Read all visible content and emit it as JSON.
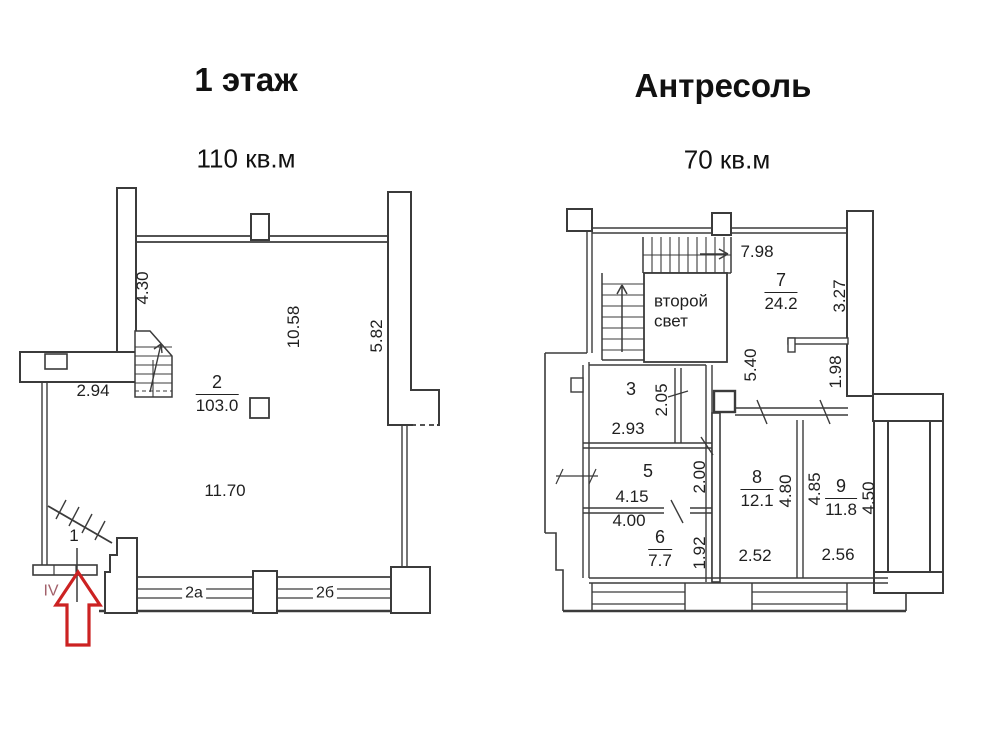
{
  "colors": {
    "line": "#3b3b3b",
    "text": "#1f1f1f",
    "arrow_red": "#cc2222",
    "roman_maroon": "#a2606a"
  },
  "left_plan": {
    "title": "1 этаж",
    "area_label": "110 кв.м",
    "rooms": [
      {
        "name": "room-2-label",
        "num": "2",
        "area": "103.0",
        "x": 217,
        "y": 394
      }
    ],
    "labels": [
      {
        "name": "dim-4-30",
        "text": "4.30",
        "x": 143,
        "y": 288,
        "rot": true,
        "size": 17
      },
      {
        "name": "dim-10-58",
        "text": "10.58",
        "x": 294,
        "y": 327,
        "rot": true,
        "size": 17
      },
      {
        "name": "dim-5-82",
        "text": "5.82",
        "x": 377,
        "y": 336,
        "rot": true,
        "size": 17
      },
      {
        "name": "dim-2-94",
        "text": "2.94",
        "x": 93,
        "y": 391,
        "size": 17
      },
      {
        "name": "dim-11-70",
        "text": "11.70",
        "x": 225,
        "y": 491,
        "size": 17
      },
      {
        "name": "room-1-number",
        "text": "1",
        "x": 74,
        "y": 536,
        "size": 17
      },
      {
        "name": "entrance-roman-numeral",
        "text": "IV",
        "x": 51,
        "y": 591,
        "size": 16,
        "color": "#a2606a"
      },
      {
        "name": "window-2a-label",
        "text": "2a",
        "x": 194,
        "y": 593,
        "size": 16,
        "bg": true
      },
      {
        "name": "window-2b-label",
        "text": "2б",
        "x": 325,
        "y": 593,
        "size": 16,
        "bg": true
      }
    ]
  },
  "right_plan": {
    "title": "Антресоль",
    "area_label": "70 кв.м",
    "second_light_lines": [
      "второй",
      "свет"
    ],
    "rooms": [
      {
        "name": "room-7-label",
        "num": "7",
        "area": "24.2",
        "x": 781,
        "y": 292
      },
      {
        "name": "room-6-label",
        "num": "6",
        "area": "7.7",
        "x": 660,
        "y": 549
      },
      {
        "name": "room-8-label",
        "num": "8",
        "area": "12.1",
        "x": 757,
        "y": 489
      },
      {
        "name": "room-9-label",
        "num": "9",
        "area": "11.8",
        "x": 841,
        "y": 498
      }
    ],
    "labels": [
      {
        "name": "dim-7-98",
        "text": "7.98",
        "x": 757,
        "y": 252,
        "size": 17
      },
      {
        "name": "dim-3-27",
        "text": "3.27",
        "x": 840,
        "y": 296,
        "rot": true,
        "size": 17
      },
      {
        "name": "dim-5-40",
        "text": "5.40",
        "x": 751,
        "y": 365,
        "rot": true,
        "size": 17
      },
      {
        "name": "dim-1-98",
        "text": "1.98",
        "x": 836,
        "y": 372,
        "rot": true,
        "size": 17
      },
      {
        "name": "room-3-number",
        "text": "3",
        "x": 631,
        "y": 390,
        "size": 18
      },
      {
        "name": "dim-2-05",
        "text": "2.05",
        "x": 662,
        "y": 400,
        "rot": true,
        "size": 17
      },
      {
        "name": "dim-2-93",
        "text": "2.93",
        "x": 628,
        "y": 429,
        "size": 17
      },
      {
        "name": "room-5-number",
        "text": "5",
        "x": 648,
        "y": 472,
        "size": 18
      },
      {
        "name": "dim-2-00",
        "text": "2.00",
        "x": 700,
        "y": 477,
        "rot": true,
        "size": 17
      },
      {
        "name": "dim-4-15",
        "text": "4.15",
        "x": 632,
        "y": 497,
        "size": 17
      },
      {
        "name": "dim-4-00",
        "text": "4.00",
        "x": 629,
        "y": 521,
        "size": 17
      },
      {
        "name": "dim-1-92",
        "text": "1.92",
        "x": 700,
        "y": 553,
        "rot": true,
        "size": 17
      },
      {
        "name": "dim-4-80",
        "text": "4.80",
        "x": 786,
        "y": 491,
        "rot": true,
        "size": 17
      },
      {
        "name": "dim-4-85",
        "text": "4.85",
        "x": 815,
        "y": 489,
        "rot": true,
        "size": 17
      },
      {
        "name": "dim-4-50",
        "text": "4.50",
        "x": 869,
        "y": 498,
        "rot": true,
        "size": 17
      },
      {
        "name": "dim-2-52",
        "text": "2.52",
        "x": 755,
        "y": 556,
        "size": 17
      },
      {
        "name": "dim-2-56",
        "text": "2.56",
        "x": 838,
        "y": 555,
        "size": 17
      }
    ]
  }
}
